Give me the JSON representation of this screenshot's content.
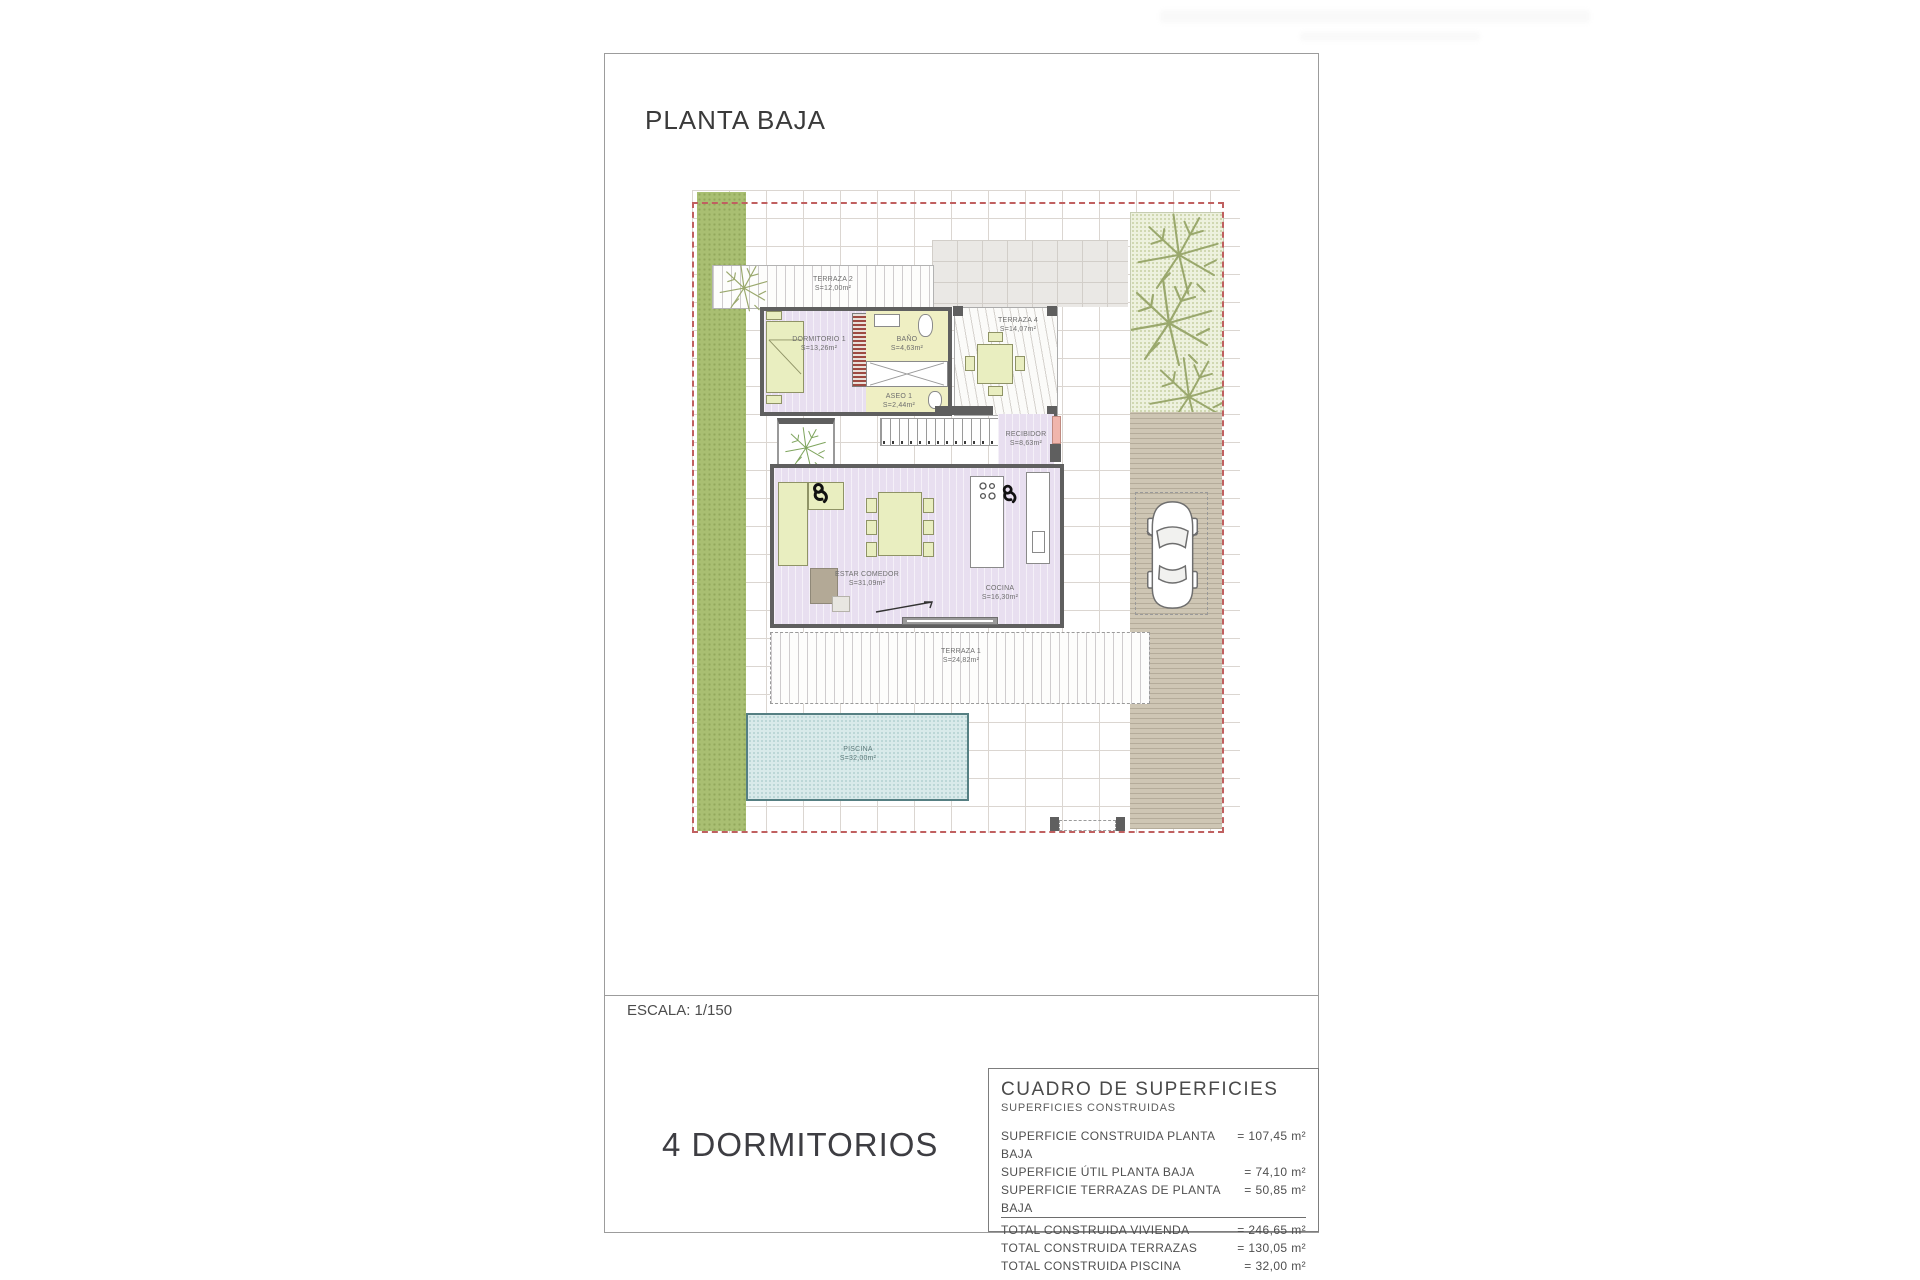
{
  "page": {
    "title": "PLANTA BAJA",
    "scale": "ESCALA: 1/150",
    "bedrooms": "4 DORMITORIOS"
  },
  "rooms": {
    "terraza2": {
      "name": "TERRAZA 2",
      "area": "S=12,00m²"
    },
    "dormitorio1": {
      "name": "DORMITORIO 1",
      "area": "S=13,26m²"
    },
    "bano": {
      "name": "BAÑO",
      "area": "S=4,63m²"
    },
    "terraza4": {
      "name": "TERRAZA 4",
      "area": "S=14,07m²"
    },
    "aseo1": {
      "name": "ASEO 1",
      "area": "S=2,44m²"
    },
    "recibidor": {
      "name": "RECIBIDOR",
      "area": "S=8,63m²"
    },
    "estar": {
      "name": "ESTAR COMEDOR",
      "area": "S=31,09m²"
    },
    "cocina": {
      "name": "COCINA",
      "area": "S=16,30m²"
    },
    "terraza1": {
      "name": "TERRAZA 1",
      "area": "S=24,82m²"
    },
    "piscina": {
      "name": "PISCINA",
      "area": "S=32,00m²"
    }
  },
  "surfaces_table": {
    "title": "CUADRO DE SUPERFICIES",
    "subtitle": "SUPERFICIES CONSTRUIDAS",
    "rows": [
      {
        "label": "SUPERFICIE CONSTRUIDA PLANTA BAJA",
        "value": "= 107,45 m²"
      },
      {
        "label": "SUPERFICIE ÚTIL PLANTA BAJA",
        "value": "= 74,10 m²"
      },
      {
        "label": "SUPERFICIE TERRAZAS DE PLANTA BAJA",
        "value": "= 50,85 m²"
      }
    ],
    "totals": [
      {
        "label": "TOTAL CONSTRUIDA VIVIENDA",
        "value": "= 246,65 m²"
      },
      {
        "label": "TOTAL CONSTRUIDA TERRAZAS",
        "value": "= 130,05 m²"
      },
      {
        "label": "TOTAL CONSTRUIDA PISCINA",
        "value": "= 32,00 m²"
      }
    ]
  },
  "colors": {
    "wall": "#5f5f5f",
    "room_fill": "#e8dff0",
    "wet_room_fill": "#efefc3",
    "furniture_fill": "#e9eec0",
    "grass": "#a9bf72",
    "pool": "#d9eaea",
    "boundary": "#c06060",
    "driveway": "#cec6b4"
  }
}
